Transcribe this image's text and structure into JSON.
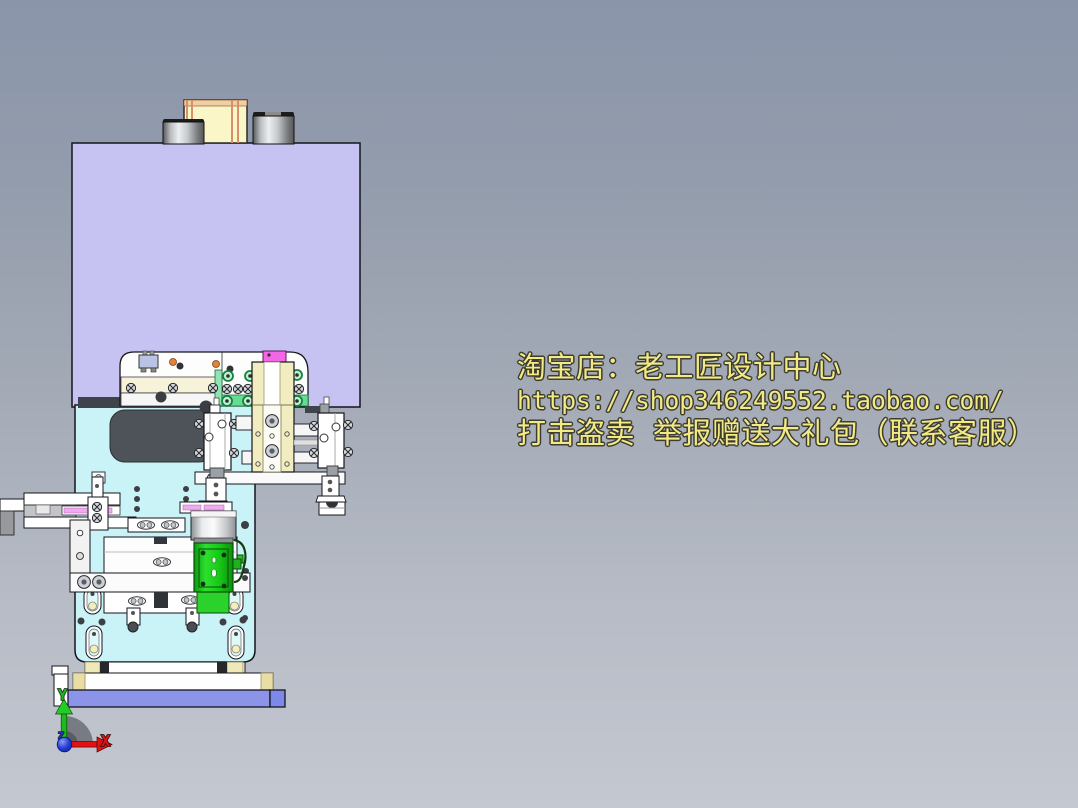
{
  "watermark": {
    "lines": [
      "淘宝店：老工匠设计中心",
      "https://shop346249552.taobao.com/",
      "打击盗卖 举报赠送大礼包（联系客服）"
    ],
    "text_color": "#f3ea85"
  },
  "axis_triad": {
    "x_label": "X",
    "y_label": "Y",
    "z_label": "Z"
  },
  "palette": {
    "background_top": "#8a95aa",
    "background_bottom": "#c4c8d1",
    "watermark_yellow": "#f3ea85",
    "head_block_lavender": "#c6c2f1",
    "body_cyan": "#c9f3f7",
    "base_blue": "#8b94e9",
    "base_blue_end": "#7e88e8",
    "actuator_green": "#17c617",
    "actuator_green_light": "#2bd22b",
    "slide_cream": "#f1edc0",
    "tooling_cream": "#f6f3da",
    "cylinder_yellow": "#faf6c8",
    "sensor_magenta": "#f566e6",
    "clamp_pink": "#efaaf0",
    "slot_dark": "#4e5359",
    "axis_x_red": "#e01212",
    "axis_y_green": "#1db91d",
    "axis_z_blue": "#1e35cf"
  }
}
